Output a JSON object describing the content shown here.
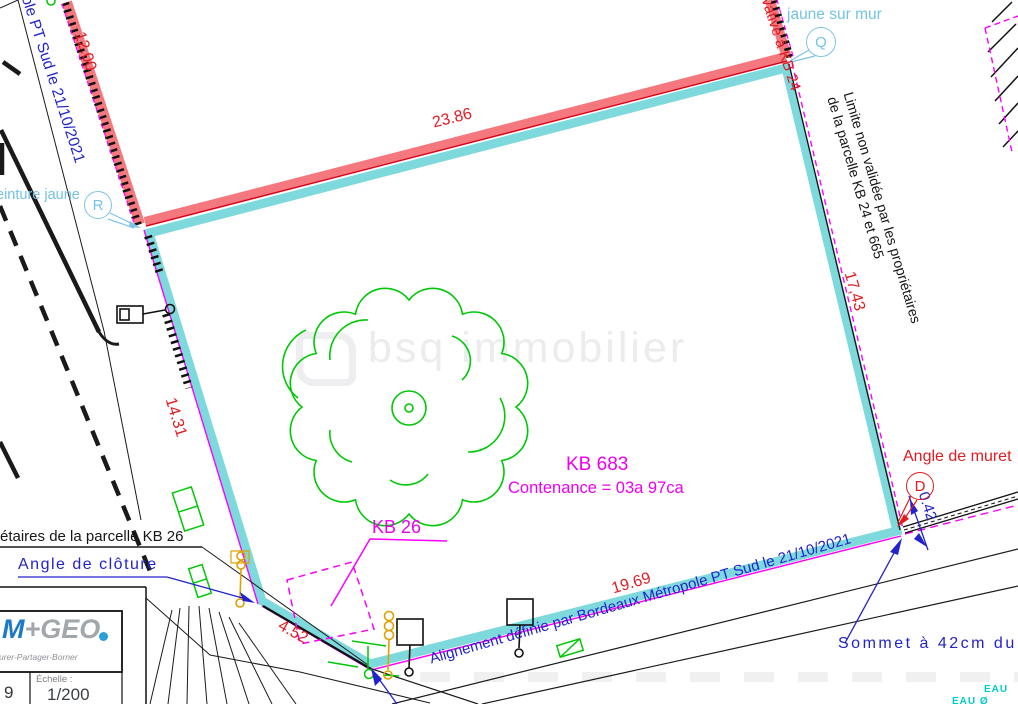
{
  "plan": {
    "watermark": "bsq immobilier",
    "parcel": {
      "id": "KB 683",
      "area": "Contenance = 03a 97ca"
    },
    "neighbor": {
      "id": "KB 26",
      "owners_note": "étaires de la parcelle KB 26"
    },
    "measurements": {
      "top": "23.86",
      "upper_left": "12.00",
      "left": "14.31",
      "lower_left": "4.52",
      "bottom": "19.69",
      "right": "17,43",
      "wall_offset": "0.42"
    },
    "annotations": {
      "alignement_left": "ole PT Sud le 21/10/2021",
      "alignement_bottom": "Alignement définie par Bordeaux Métropole PT Sud le 21/10/2021",
      "limite_line1": "Limite non validée par les propriétaires",
      "limite_line2": "de la parcelle KB 24 et 665",
      "privative": "vative à KB 24",
      "clou_line1": "Antérieur du clou",
      "clou_line2": "jaune sur mur",
      "peinture": "einture jaune",
      "angle_cloture": "Angle de clôture",
      "angle_muret": "Angle de muret",
      "sommet": "Sommet à 42cm du",
      "eau": "EAU",
      "eau2": "EAU Ø"
    },
    "markers": {
      "r": "R",
      "q": "Q",
      "d": "D"
    },
    "title_block": {
      "number": "9",
      "scale_label": "Échelle :",
      "scale_value": "1/200",
      "logo_m": "M",
      "logo_plus": "+",
      "logo_geo": "GEO",
      "tagline": "esurer-Partager-Borner"
    }
  }
}
